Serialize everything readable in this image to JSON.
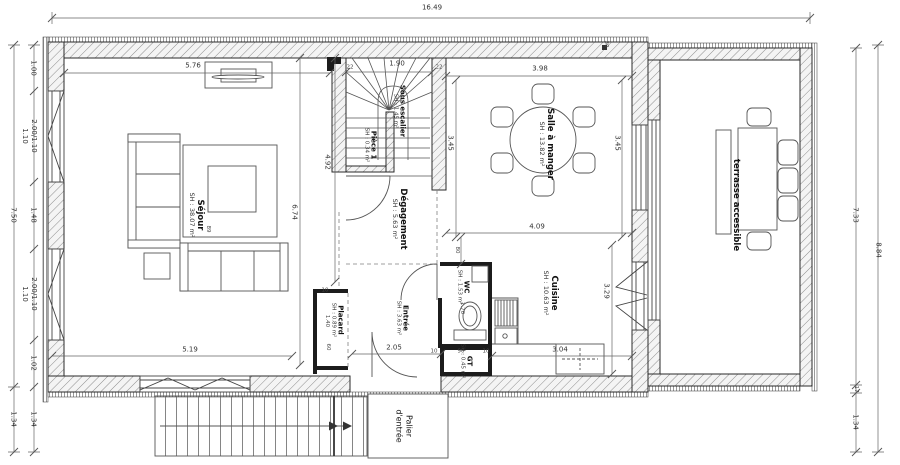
{
  "rooms": {
    "sejour": {
      "name": "Séjour",
      "area": "SH : 38.07 m²"
    },
    "sous_escalier": {
      "name": "Sous escalier",
      "area": "SH : 1.45 m²"
    },
    "piece1": {
      "name": "Pièce 1",
      "area": "SH : 0.34 m²"
    },
    "degagement": {
      "name": "Dégagement",
      "area": "SH : 5.63 m²"
    },
    "salle_a_manger": {
      "name": "Salle à manger",
      "area": "SH : 13.82 m²"
    },
    "cuisine": {
      "name": "Cuisine",
      "area": "SH : 10.63 m²"
    },
    "wc": {
      "name": "WC",
      "area": "SH : 1.53 m²"
    },
    "entree": {
      "name": "Entrée",
      "area": "SH : 3.63 m²"
    },
    "placard": {
      "name": "Placard",
      "area": "SH : 0.89 m²"
    },
    "gt": {
      "name": "GT",
      "area": "SH : 0.45 m²"
    },
    "terrasse": {
      "name": "terrasse accessible"
    },
    "palier": {
      "name": "Palier d'entrée"
    }
  },
  "dims": {
    "overall_width": "16.49",
    "left_outer_top": "7.50",
    "left_outer_bottom": "1.34",
    "left_chain": [
      "1.00",
      "2.00/1.10",
      "1.10",
      "1.48",
      "2.00/1.10",
      "1.10",
      "1.02",
      "1.34"
    ],
    "right_terrace": "7.33",
    "right_wall": "17",
    "right_bottom": "1.34",
    "right_outer": "8.84",
    "sejour_width": "5.76",
    "sejour_height": "6.74",
    "sejour_note": "89",
    "sejour_bottom": "5.19",
    "stair_width": "1.90",
    "wall_thick_left": "22",
    "wall_thick_right": "22",
    "wall_thick_top": "30",
    "salle_width": "3.98",
    "salle_left": "3.45",
    "salle_right": "3.45",
    "degagement_len": "4.92",
    "cuisine_width": "4.09",
    "cuisine_right": "3.29",
    "cuisine_bottom": "3.04",
    "wc_offset": "80",
    "wc_depth": "1.70",
    "entree_door": "2.05",
    "placard_len": "1.40",
    "placard_depth": "60",
    "gt_width": "90",
    "thick_a": "10",
    "thick_b": "10",
    "thick_c": "10"
  }
}
